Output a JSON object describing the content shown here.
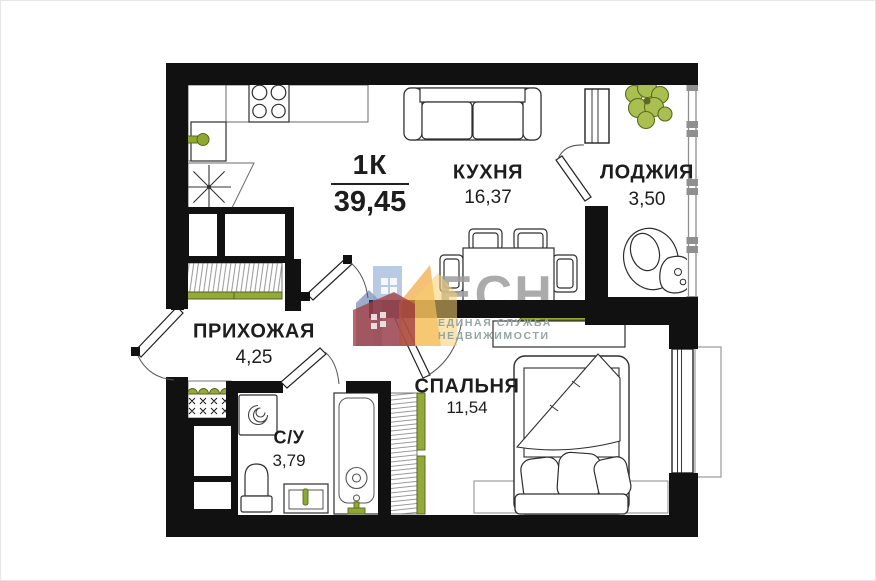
{
  "plan": {
    "type_label": "1К",
    "total_area": "39,45",
    "rooms": [
      {
        "name": "КУХНЯ",
        "area": "16,37"
      },
      {
        "name": "ЛОДЖИЯ",
        "area": "3,50"
      },
      {
        "name": "ПРИХОЖАЯ",
        "area": "4,25"
      },
      {
        "name": "С/У",
        "area": "3,79"
      },
      {
        "name": "СПАЛЬНЯ",
        "area": "11,54"
      }
    ],
    "watermark": {
      "logo_text": "ЕСН",
      "subtitle_line1": "ЕДИНАЯ СЛУЖБА",
      "subtitle_line2": "НЕДВИЖИМОСТИ"
    },
    "colors": {
      "wall": "#111111",
      "accent_green": "#93aa39",
      "accent_green_dark": "#55611f",
      "logo_gray": "#9d9d9d",
      "logo_subtitle": "#95a5a3"
    },
    "icons": [
      "stove-icon",
      "sink-icon",
      "fridge-star-icon",
      "sofa-icon",
      "dining-table-icon",
      "plant-icon",
      "armchair-icon",
      "side-table-icon",
      "wardrobe-icon",
      "shoe-rack-icon",
      "washing-machine-icon",
      "toilet-icon",
      "vanity-sink-icon",
      "shower-icon",
      "bed-icon",
      "dresser-icon",
      "rug-icon",
      "window-icon",
      "door-swing-icon",
      "logo-houses-icon"
    ]
  }
}
